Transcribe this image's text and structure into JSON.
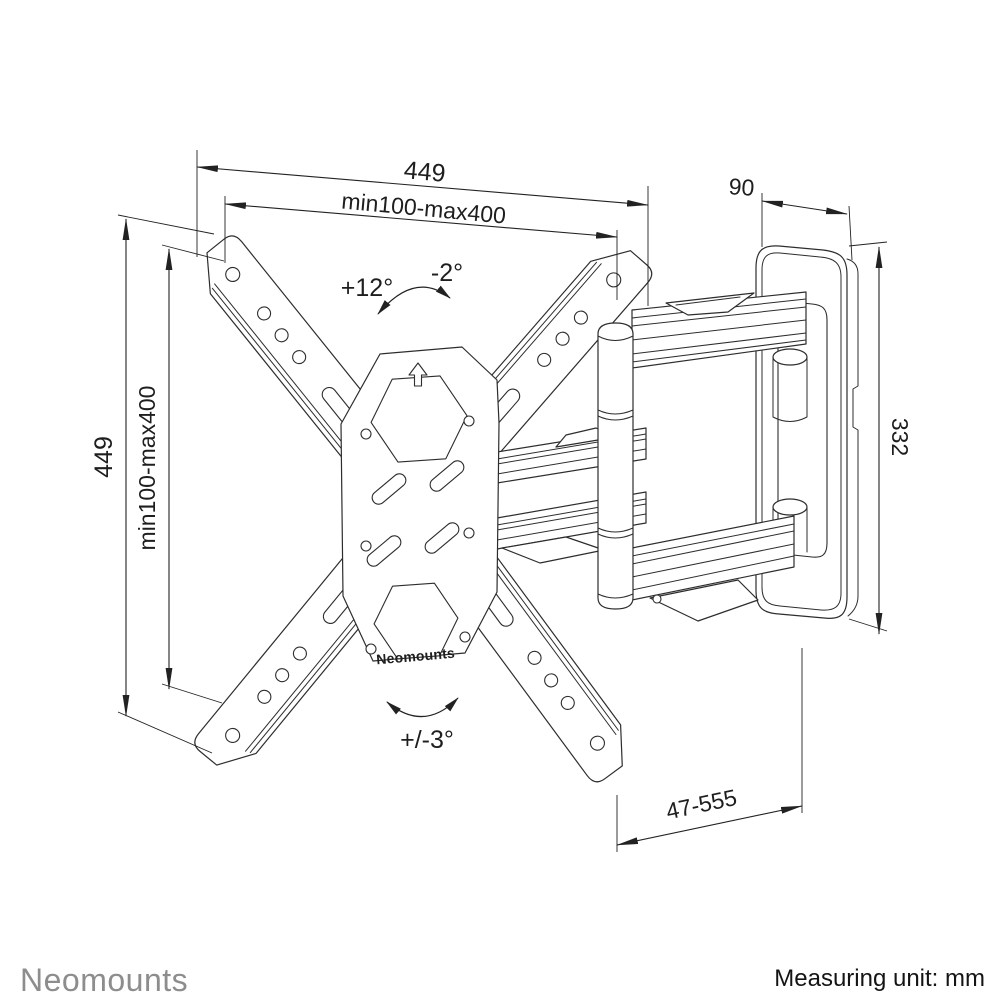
{
  "drawing": {
    "title": "TV wall mount dimensional drawing",
    "product_label": "Neomounts",
    "dimensions": {
      "top_width": "449",
      "top_vesa_range": "min100-max400",
      "left_height": "449",
      "left_vesa_range": "min100-max400",
      "wall_plate_depth": "90",
      "wall_plate_height": "332",
      "extension_range": "47-555"
    },
    "angles": {
      "tilt_up": "+12°",
      "tilt_down": "-2°",
      "swivel": "+/-3°"
    }
  },
  "footer": {
    "brand": "Neomounts",
    "measuring_unit": "Measuring unit: mm"
  },
  "colors": {
    "line": "#2d2d2d",
    "dimension": "#222222",
    "brand_gray": "#8d8d8d",
    "background": "#ffffff"
  }
}
